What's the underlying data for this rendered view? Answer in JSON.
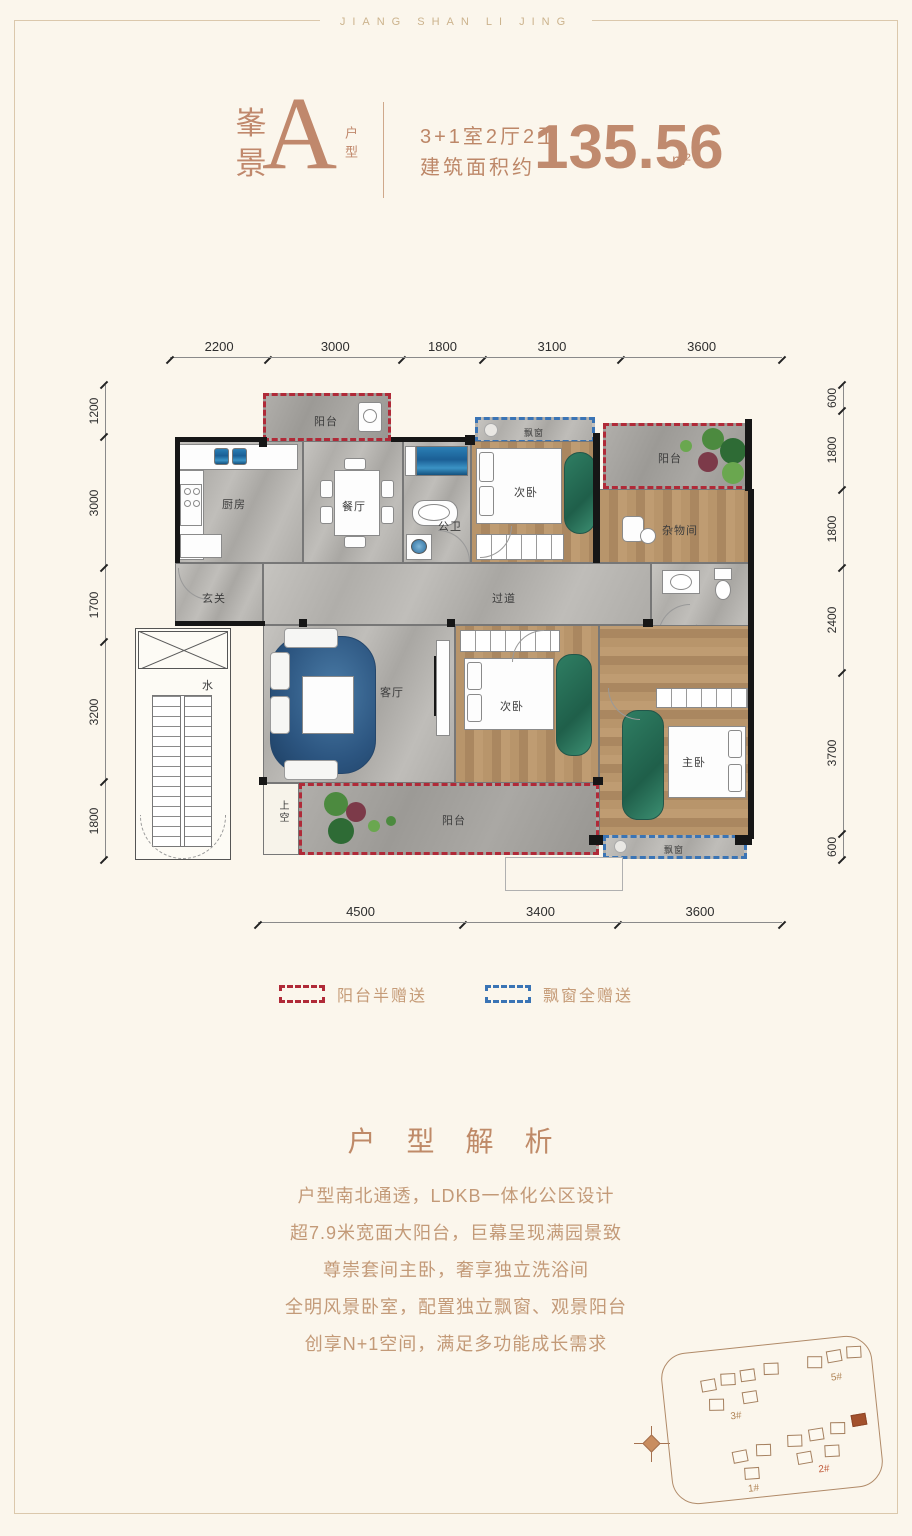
{
  "brand": "JIANG SHAN LI JING",
  "header": {
    "name_line1": "峯",
    "name_line2": "景",
    "letter": "A",
    "suffix": "户型",
    "spec_rooms": "3+1室2厅2卫",
    "spec_area_label": "建筑面积约",
    "area_value": "135.56",
    "area_unit": "m²"
  },
  "dimensions": {
    "top": [
      "2200",
      "3000",
      "1800",
      "3100",
      "3600"
    ],
    "left": [
      "1200",
      "3000",
      "1700",
      "3200",
      "1800"
    ],
    "right": [
      "600",
      "1800",
      "1800",
      "2400",
      "3700",
      "600"
    ],
    "bottom": [
      "4500",
      "3400",
      "3600"
    ]
  },
  "rooms": {
    "balcony_north": "阳台",
    "kitchen": "厨房",
    "dining": "餐厅",
    "guest_bath": "公卫",
    "bedroom_north": "次卧",
    "bay_window_north": "飘窗",
    "balcony_northeast": "阳台",
    "storage": "杂物间",
    "foyer": "玄关",
    "corridor": "过道",
    "master_bath": "主卫",
    "living": "客厅",
    "bedroom_south": "次卧",
    "master_bedroom": "主卧",
    "bay_window_south": "飘窗",
    "balcony_south": "阳台",
    "void_space": "上空",
    "water": "水"
  },
  "legend": {
    "balcony_gift": "阳台半赠送",
    "bay_gift": "飘窗全赠送"
  },
  "analysis": {
    "title": "户 型 解 析",
    "lines": [
      "户型南北通透，LDKB一体化公区设计",
      "超7.9米宽面大阳台，巨幕呈现满园景致",
      "尊崇套间主卧，奢享独立洗浴间",
      "全明风景卧室，配置独立飘窗、观景阳台",
      "创享N+1空间，满足多功能成长需求"
    ]
  },
  "siteplan": {
    "buildings": [
      "3#",
      "5#",
      "1#",
      "2#"
    ]
  },
  "colors": {
    "accent": "#c0886c",
    "body_text": "#c39a78",
    "balcony_gift_red": "#b02a38",
    "bay_gift_blue": "#3a74b5"
  }
}
